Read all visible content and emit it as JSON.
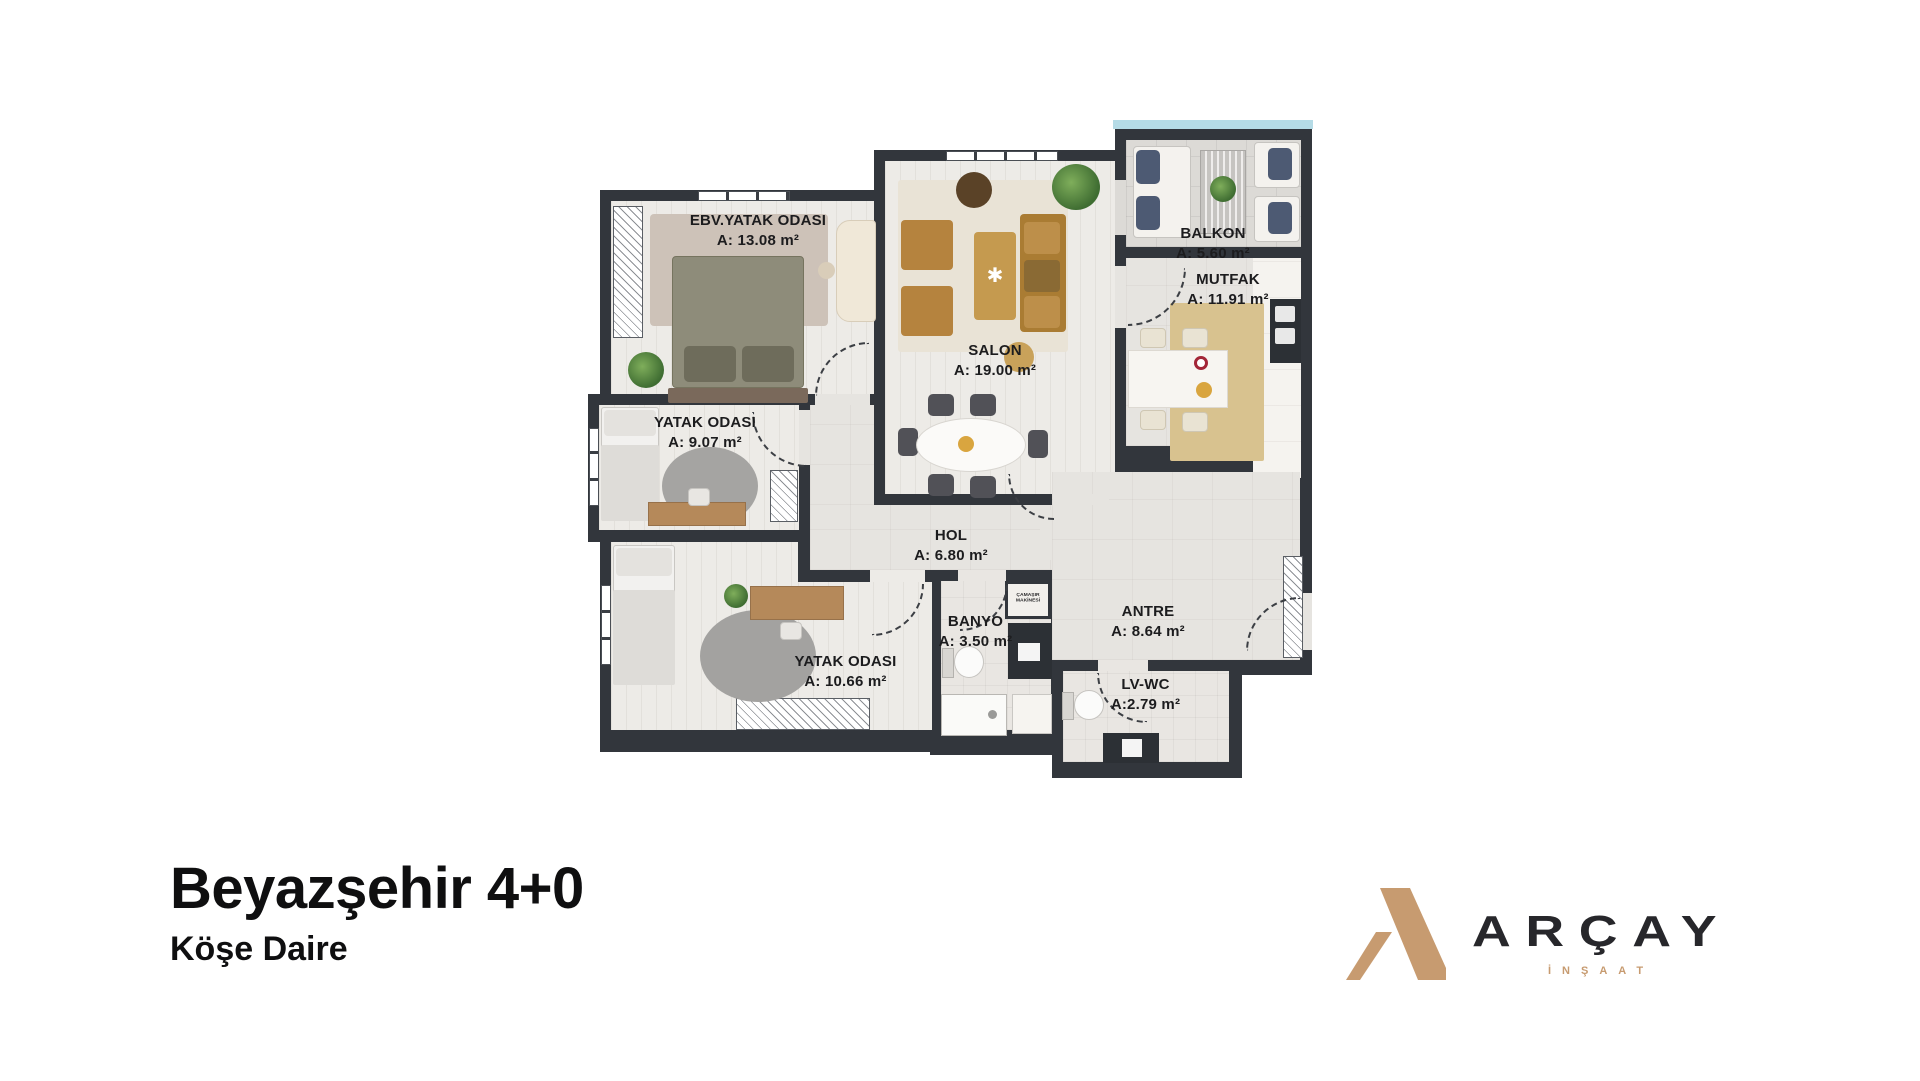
{
  "floor_plan": {
    "rooms": [
      {
        "name": "EBV.YATAK ODASI",
        "area": "A: 13.08 m²"
      },
      {
        "name": "SALON",
        "area": "A: 19.00 m²"
      },
      {
        "name": "BALKON",
        "area": "A: 5.60 m²"
      },
      {
        "name": "MUTFAK",
        "area": "A: 11.91 m²"
      },
      {
        "name": "YATAK ODASI",
        "area": "A: 9.07 m²"
      },
      {
        "name": "HOL",
        "area": "A: 6.80 m²"
      },
      {
        "name": "YATAK ODASI",
        "area": "A: 10.66 m²"
      },
      {
        "name": "BANYO",
        "area": "A: 3.50 m²"
      },
      {
        "name": "ANTRE",
        "area": "A: 8.64 m²"
      },
      {
        "name": "LV-WC",
        "area": "A:2.79 m²"
      }
    ],
    "laundry_label": {
      "line1": "ÇAMAŞIR",
      "line2": "MAKİNESİ"
    },
    "colors": {
      "wall": "#32363c",
      "wood_floor": "#edebe7",
      "tile_floor": "#dcdad6",
      "sky": "#b5dbe6",
      "rug_beige": "#cdc2b8",
      "rug_gray": "#a3a2a0",
      "rug_gold": "#d8c28f",
      "wood_furniture": "#b5833e",
      "bed_sage": "#8e8c7a"
    }
  },
  "footer": {
    "title": "Beyazşehir 4+0",
    "subtitle": "Köşe Daire"
  },
  "brand": {
    "wordmark": "ARÇAY",
    "tagline": "İNŞAAT",
    "accent": "#c79b70",
    "dark": "#27272b"
  }
}
